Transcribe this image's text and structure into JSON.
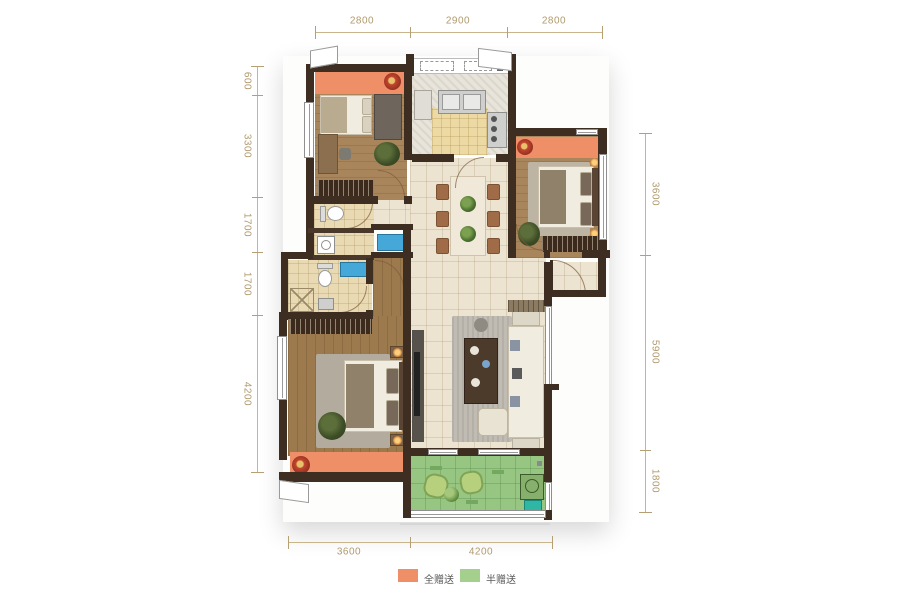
{
  "dimensions": {
    "top": [
      "2800",
      "2900",
      "2800"
    ],
    "left": [
      "600",
      "3300",
      "1700",
      "1700",
      "4200"
    ],
    "right": [
      "3600",
      "5900",
      "1800"
    ],
    "bottom": [
      "3600",
      "4200"
    ]
  },
  "legend": {
    "items": [
      {
        "label": "全赠送",
        "color": "#ef8f68"
      },
      {
        "label": "半赠送",
        "color": "#a5cf8d"
      }
    ]
  },
  "colors": {
    "full_gift_orange": "#ef8f68",
    "half_gift_green": "#97c683",
    "wall_dark_brown": "#3e2d21",
    "wood_floor": "#a9855b",
    "hall_tile": "#ece3d1",
    "bath_floor": "#e9dab3",
    "water_blue": "#45a8d9",
    "dimension_tan": "#b09a6e"
  },
  "icons": {
    "flower": "radial red-orange blossom",
    "plant": "dark green foliage circle",
    "toilet": "white tank + bowl shape",
    "bathtub": "blue rectangle",
    "stove": "gray panel with 4 burner dots",
    "sink": "steel double basin",
    "ac_unit": "green box with fan circle"
  }
}
